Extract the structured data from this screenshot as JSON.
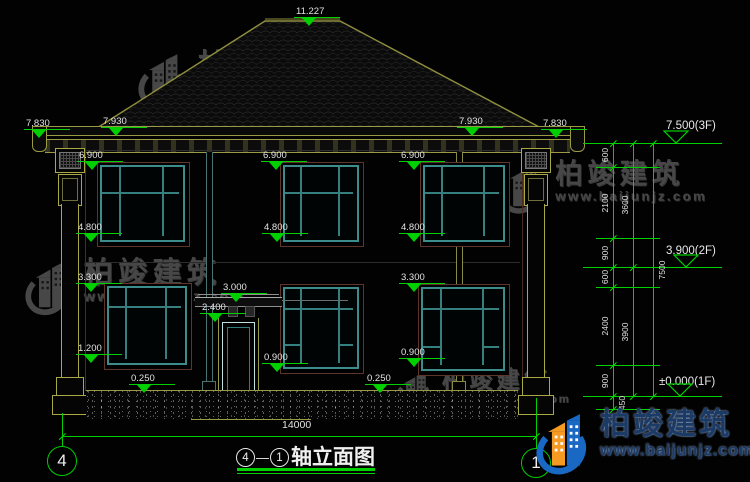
{
  "drawing": {
    "title": {
      "axis_start": "4",
      "dash": "—",
      "axis_end": "1",
      "name": "轴立面图"
    },
    "bottom_width_dim": "14000",
    "axis_bubbles": [
      {
        "label": "4",
        "x": 62,
        "y": 461
      },
      {
        "label": "1",
        "x": 536,
        "y": 463
      }
    ]
  },
  "brand": {
    "name": "柏竣建筑",
    "url": "www.baijunjz.com"
  },
  "level_markers": [
    {
      "label": "11.227",
      "x": 296,
      "y": 6
    },
    {
      "label": "7.830",
      "x": 26,
      "y": 118
    },
    {
      "label": "7.930",
      "x": 103,
      "y": 116
    },
    {
      "label": "7.930",
      "x": 459,
      "y": 116
    },
    {
      "label": "7.830",
      "x": 543,
      "y": 118
    },
    {
      "label": "6.900",
      "x": 79,
      "y": 150
    },
    {
      "label": "6.900",
      "x": 263,
      "y": 150
    },
    {
      "label": "6.900",
      "x": 401,
      "y": 150
    },
    {
      "label": "4.800",
      "x": 78,
      "y": 222
    },
    {
      "label": "4.800",
      "x": 264,
      "y": 222
    },
    {
      "label": "4.800",
      "x": 401,
      "y": 222
    },
    {
      "label": "3.300",
      "x": 78,
      "y": 272
    },
    {
      "label": "3.300",
      "x": 401,
      "y": 272
    },
    {
      "label": "3.000",
      "x": 223,
      "y": 282
    },
    {
      "label": "2.400",
      "x": 202,
      "y": 302
    },
    {
      "label": "1.200",
      "x": 78,
      "y": 343
    },
    {
      "label": "0.900",
      "x": 264,
      "y": 352
    },
    {
      "label": "0.900",
      "x": 401,
      "y": 347
    },
    {
      "label": "0.250",
      "x": 131,
      "y": 373
    },
    {
      "label": "0.250",
      "x": 367,
      "y": 373
    }
  ],
  "right_markers": [
    {
      "label": "7.500(3F)",
      "x": 666,
      "y": 120,
      "line_y": 143,
      "apex_x": 676
    },
    {
      "label": "3.900(2F)",
      "x": 666,
      "y": 245,
      "line_y": 267,
      "apex_x": 686
    },
    {
      "label": "±0.000(1F)",
      "x": 659,
      "y": 376,
      "line_y": 396,
      "apex_x": 680
    }
  ],
  "dim_chains": [
    {
      "x": 613,
      "segments": [
        {
          "v": "600",
          "y1": 143,
          "y2": 167
        },
        {
          "v": "2100",
          "y1": 167,
          "y2": 238
        },
        {
          "v": "900",
          "y1": 238,
          "y2": 267
        },
        {
          "v": "600",
          "y1": 267,
          "y2": 287
        },
        {
          "v": "2400",
          "y1": 287,
          "y2": 365
        },
        {
          "v": "900",
          "y1": 365,
          "y2": 396
        },
        {
          "v": "450",
          "y1": 396,
          "y2": 409,
          "side": "right"
        }
      ]
    },
    {
      "x": 633,
      "segments": [
        {
          "v": "3600",
          "y1": 143,
          "y2": 267
        },
        {
          "v": "3900",
          "y1": 267,
          "y2": 396
        }
      ]
    },
    {
      "x": 653,
      "segments": [
        {
          "v": "7500",
          "y1": 143,
          "y2": 396,
          "side": "right"
        }
      ]
    }
  ],
  "watermarks": [
    {
      "x": 138,
      "y": 50,
      "scale": 1.0
    },
    {
      "x": 500,
      "y": 160,
      "scale": 0.92
    },
    {
      "x": 25,
      "y": 258,
      "scale": 0.98
    },
    {
      "x": 395,
      "y": 368,
      "scale": 0.78
    }
  ],
  "colors": {
    "dim_green": "#00cf00",
    "roof_line": "#8f8f3f",
    "cornice_yellow": "#a8a845",
    "window_teal": "#3d8c8c",
    "frame_brown": "#5e352a",
    "logo_blue": "#1868c4",
    "logo_orange": "#f59a23",
    "watermark_gray": "#4d4d4d"
  }
}
